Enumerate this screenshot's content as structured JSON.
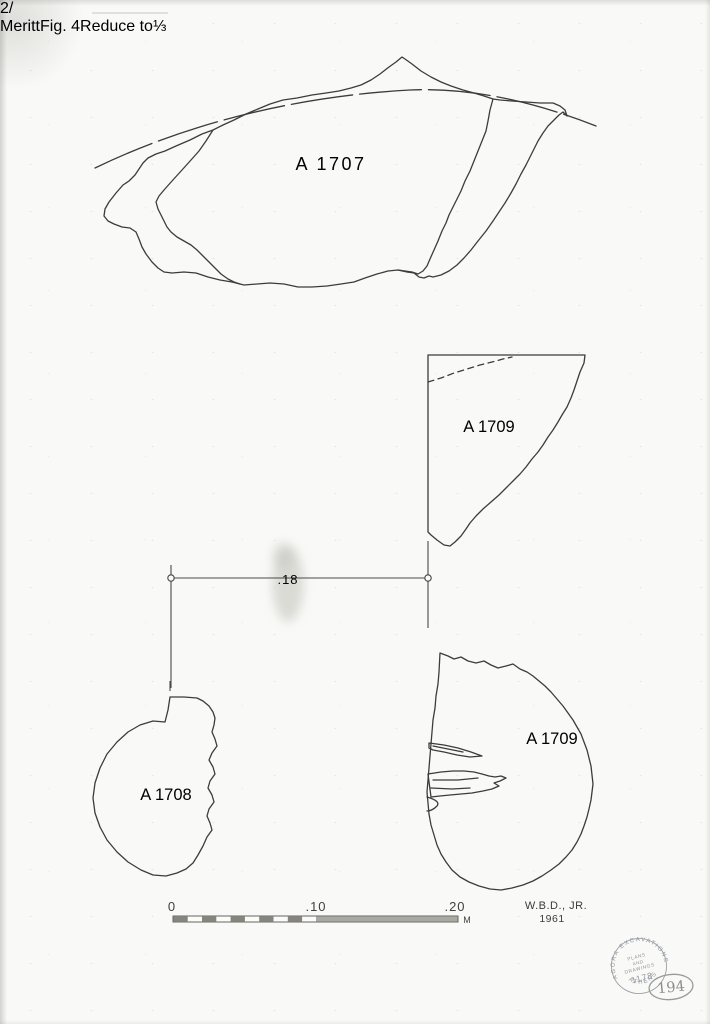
{
  "drawing": {
    "labels": {
      "a1707": "A 1707",
      "a1709_upper": "A 1709",
      "a1708": "A 1708",
      "a1709_lower": "A 1709"
    },
    "dimension_label": ".18",
    "scale": {
      "zero": "0",
      "ten": ".10",
      "twenty": ".20",
      "unit": "M"
    },
    "signature": {
      "name": "W.B.D., JR.",
      "year": "1961"
    },
    "stamp": {
      "arc_text": "AGORA EXCAVATIONS",
      "bottom_text": "ATHENS",
      "center_line1": "PLANS",
      "center_line2": "AND",
      "center_line3": "DRAWINGS",
      "number": "1178"
    },
    "page_number": "194",
    "pencil_notes": {
      "corner_mark": "2/",
      "name": "Meritt",
      "figure": "Fig. 4",
      "instruction": "Reduce to",
      "fraction": "⅓"
    }
  }
}
